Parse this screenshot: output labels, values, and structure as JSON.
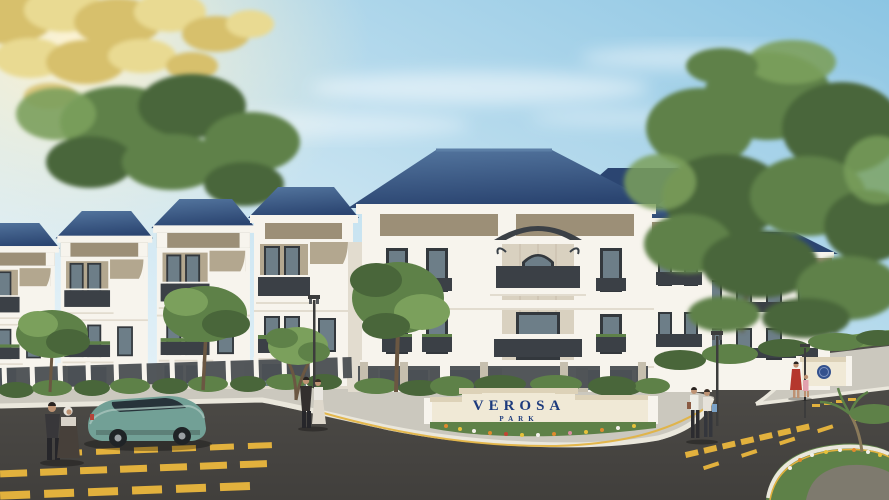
{
  "sign": {
    "line1": "VEROSA",
    "line2": "PARK"
  },
  "colors": {
    "sky_top": "#8cc5e3",
    "sky_mid": "#c9e4f1",
    "sky_horizon": "#f2f8fb",
    "sun_glow": "#fff3d0",
    "cloud": "#ffffff",
    "roof": "#2b4571",
    "roof_light": "#54769f",
    "facade": "#f7f4ed",
    "facade_shade": "#e2dccf",
    "accent": "#9c8f77",
    "accent_light": "#b3a78f",
    "frame": "#33383d",
    "glass": "#6d7e88",
    "railing": "#3b4046",
    "stone": "#c6bfae",
    "stone_light": "#d9d1c0",
    "sidewalk": "#cbc8be",
    "curb": "#eae7dc",
    "road": "#514f4b",
    "road_dark": "#413f3c",
    "marking": "#e2b13d",
    "sign_wall": "#f0e9d6",
    "sign_wall_shade": "#ddd2b8",
    "sign_text": "#1d3b7d",
    "car": "#72a096",
    "car_dark": "#547d74",
    "foliage_dark": "#49663a",
    "foliage_mid": "#5e8148",
    "foliage_light": "#7ba05c",
    "foliage_gold": "#d7c06c",
    "foliage_gold_light": "#e9da92",
    "grass": "#6f9450",
    "trunk": "#6b5742",
    "skin": "#bd9273"
  }
}
